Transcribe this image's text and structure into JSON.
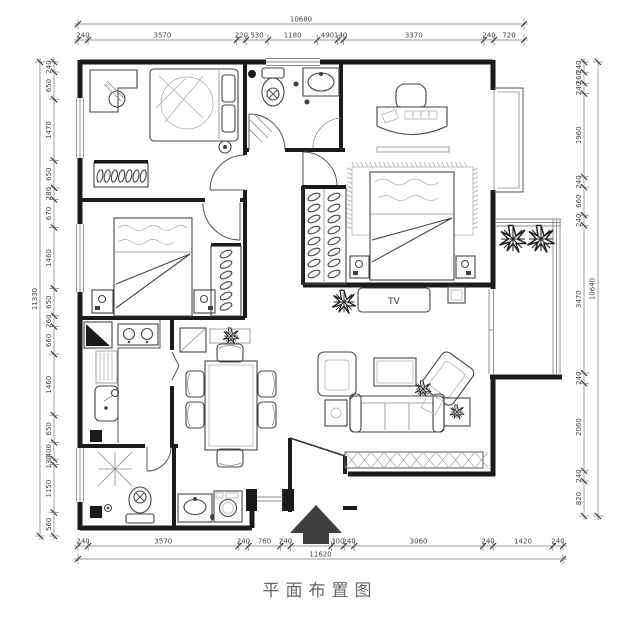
{
  "title": {
    "text": "平面布置图"
  },
  "plan": {
    "tv_label": "TV"
  },
  "dimensions": {
    "top": {
      "total": "10680",
      "segments": [
        "240",
        "3570",
        "220",
        "530",
        "1180",
        "490",
        "140",
        "3370",
        "240",
        "720"
      ]
    },
    "bottom": {
      "total": "11620",
      "segments": [
        "240",
        "3570",
        "240",
        "760",
        "240",
        "970",
        "300",
        "240",
        "3060",
        "240",
        "1420",
        "240"
      ]
    },
    "left": {
      "total": "11330",
      "segments": [
        "240",
        "650",
        "1470",
        "650",
        "280",
        "670",
        "1460",
        "650",
        "260",
        "660",
        "1460",
        "650",
        "400",
        "130",
        "1150",
        "560"
      ]
    },
    "right": {
      "total": "10640",
      "segments": [
        "240",
        "260",
        "240",
        "1960",
        "240",
        "660",
        "240",
        "3470",
        "240",
        "2060",
        "240",
        "820"
      ]
    }
  },
  "icons": {
    "entry_arrow": "▲",
    "plant": "✳",
    "toilet_valve": "⊗"
  },
  "colors": {
    "wall": "#1b1b1b",
    "furniture": "#444",
    "dim_text": "#444",
    "title_text": "#666",
    "paper": "#ffffff"
  }
}
